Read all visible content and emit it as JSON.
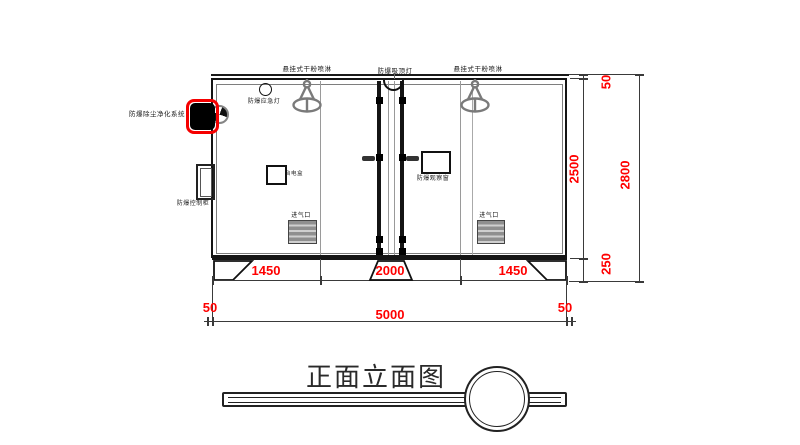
{
  "title": "正面立面图",
  "labels": {
    "sprinkler_left": "悬挂式干粉喷淋",
    "ceiling_lamp": "防爆吸顶灯",
    "sprinkler_right": "悬挂式干粉喷淋",
    "emergency_light": "防爆应急灯",
    "purifier_system": "防爆除尘净化系统",
    "control_cabinet": "防爆控制柜",
    "power_box": "台电盒",
    "observation_window": "防爆观察窗",
    "air_inlet_left": "进气口",
    "air_inlet_right": "进气口"
  },
  "dimensions": {
    "bottom_segments": [
      "1450",
      "2000",
      "1450"
    ],
    "bottom_total": "5000",
    "bottom_offset_left": "50",
    "bottom_offset_right": "50",
    "right_top_offset": "50",
    "right_inner_height": "2500",
    "right_base_height": "250",
    "right_total_height": "2800"
  },
  "colors": {
    "dimension_text": "#ff0000",
    "highlight_box": "#ff0000",
    "drawing_line": "#1a1a1a",
    "equipment_gray": "#7a7a7a"
  }
}
